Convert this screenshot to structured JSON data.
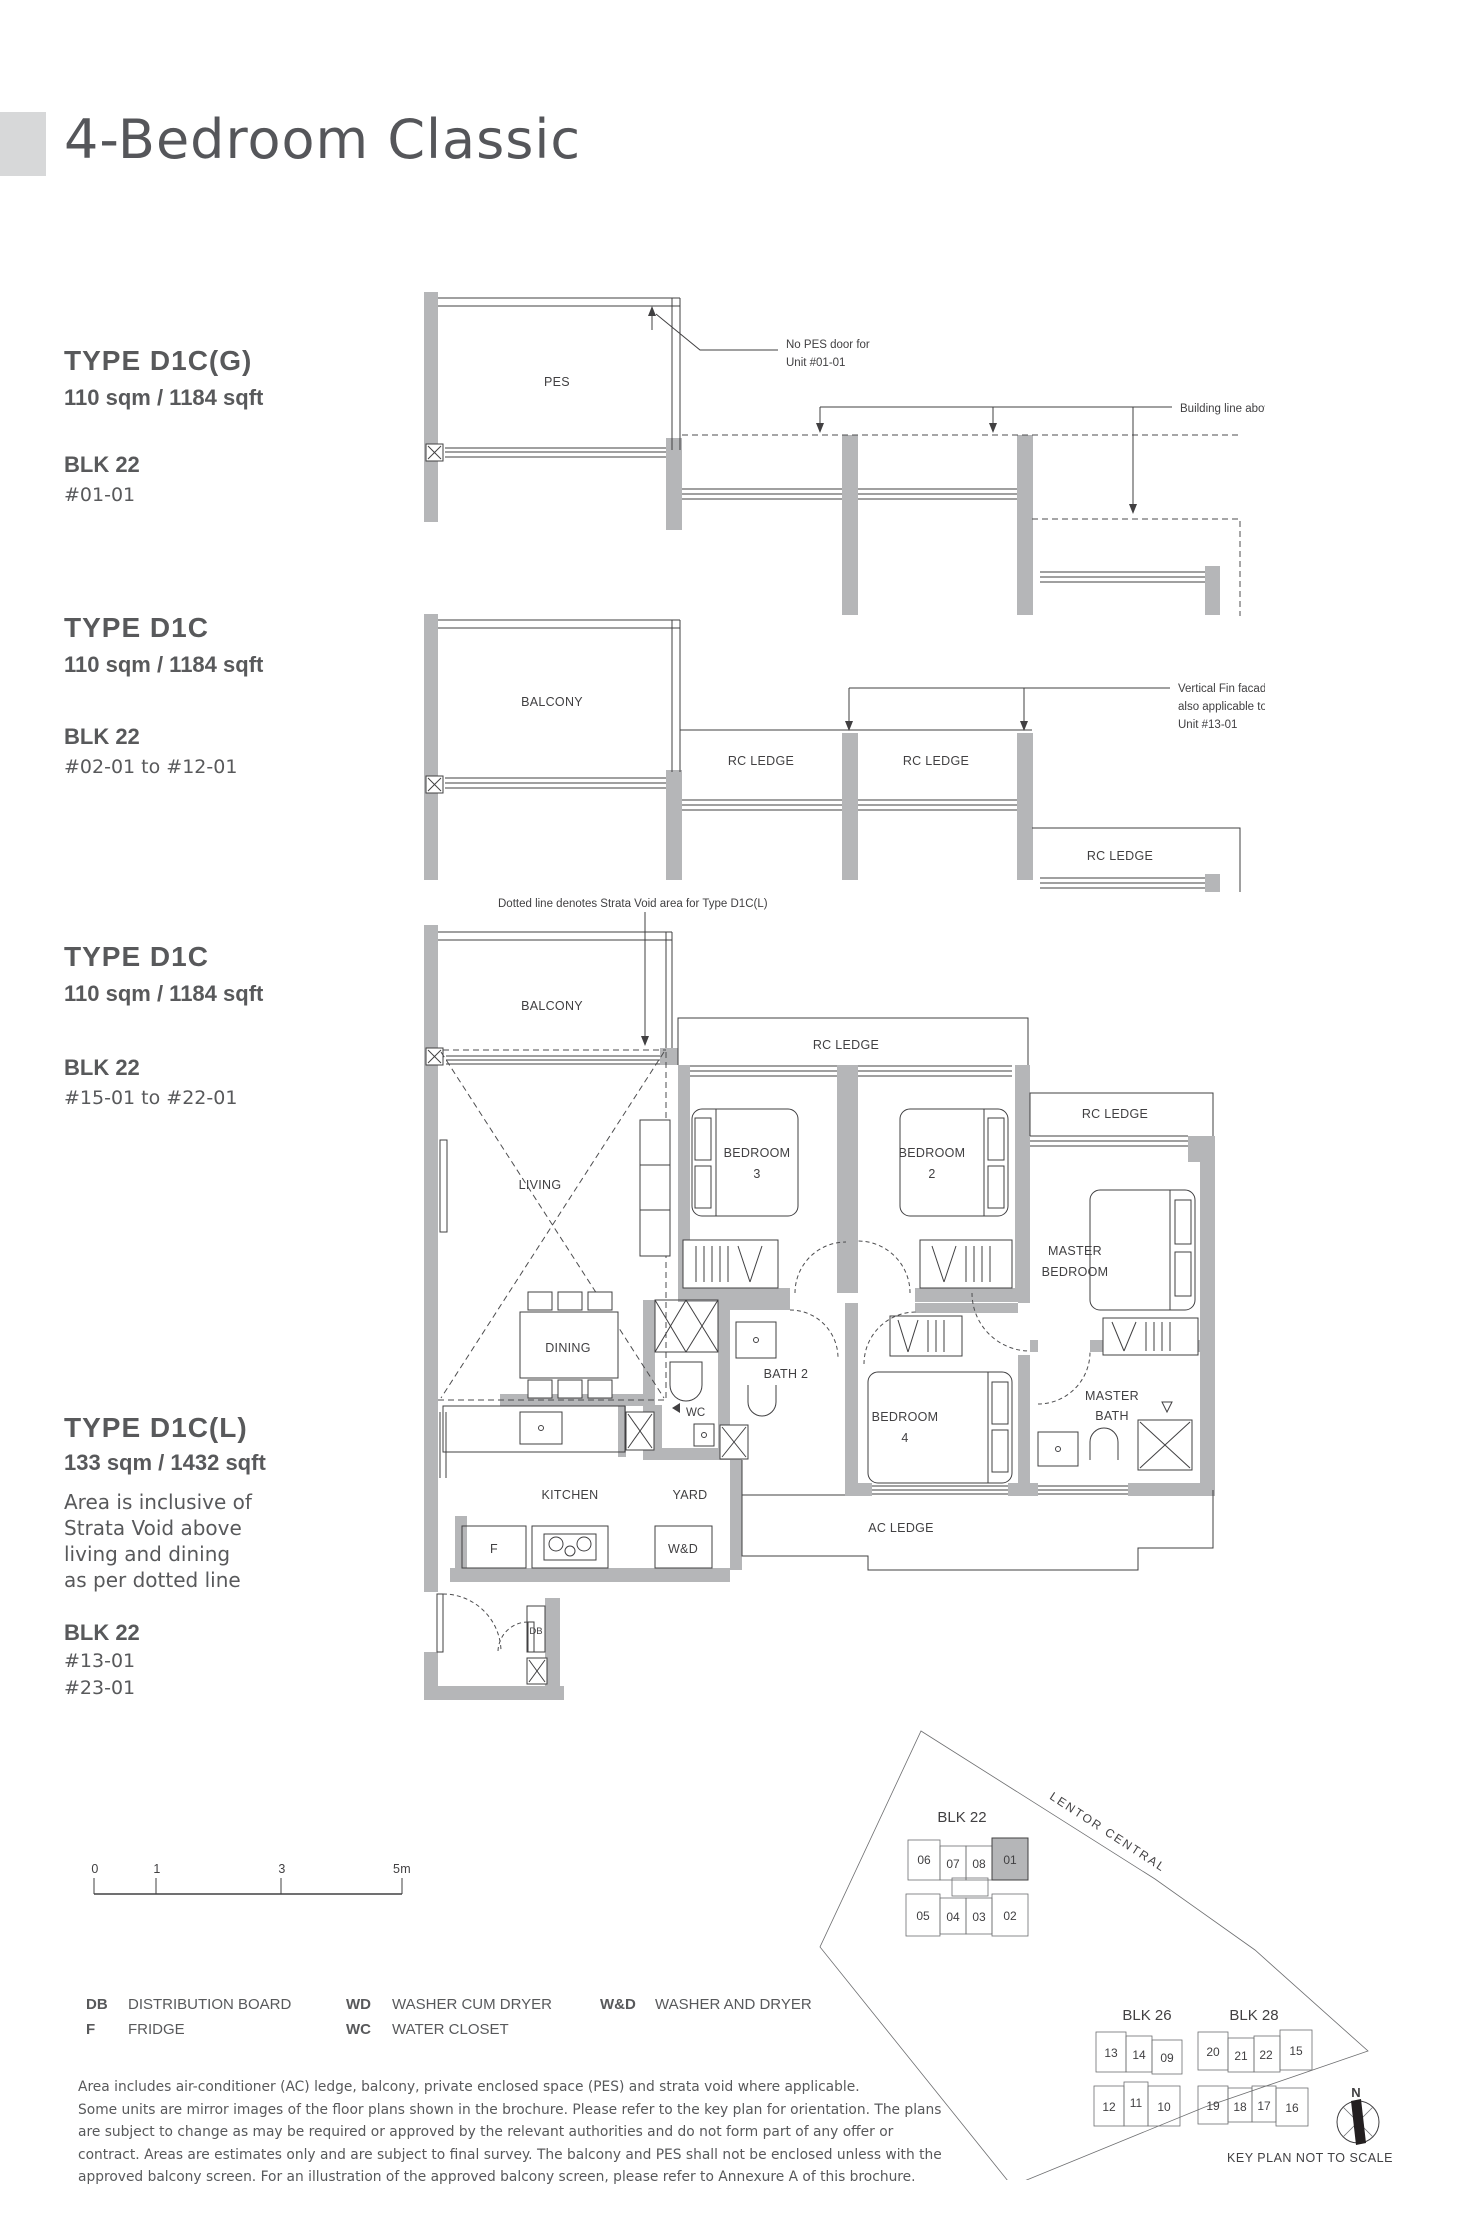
{
  "page": {
    "title": "4-Bedroom Classic"
  },
  "colors": {
    "text": "#58595b",
    "line": "#414042",
    "wall": "#b5b6b8",
    "highlight": "#b5b6b8"
  },
  "sections": {
    "s1": {
      "type_label": "TYPE D1C(G)",
      "area": "110 sqm / 1184 sqft",
      "blk": "BLK 22",
      "units": "#01-01"
    },
    "s2": {
      "type_label": "TYPE D1C",
      "area": "110 sqm / 1184 sqft",
      "blk": "BLK 22",
      "units": "#02-01 to #12-01"
    },
    "s3": {
      "type_label": "TYPE D1C",
      "area": "110 sqm / 1184 sqft",
      "blk": "BLK 22",
      "units": "#15-01 to #22-01"
    },
    "s4": {
      "type_label": "TYPE D1C(L)",
      "area": "133 sqm / 1432 sqft",
      "note1": "Area is inclusive of",
      "note2": "Strata Void above",
      "note3": "living and dining",
      "note4": "as per dotted line",
      "blk": "BLK 22",
      "units1": "#13-01",
      "units2": "#23-01"
    }
  },
  "plan1": {
    "pes": "PES",
    "note_pes1": "No PES door for",
    "note_pes2": "Unit #01-01",
    "note_building": "Building line above"
  },
  "plan2": {
    "balcony": "BALCONY",
    "rc_ledge1": "RC LEDGE",
    "rc_ledge2": "RC LEDGE",
    "rc_ledge3": "RC LEDGE",
    "fin1": "Vertical Fin facade",
    "fin2": "also applicable to",
    "fin3": "Unit #13-01"
  },
  "plan3": {
    "strata_note": "Dotted line denotes Strata Void area for Type D1C(L)",
    "balcony": "BALCONY",
    "living": "LIVING",
    "dining": "DINING",
    "kitchen": "KITCHEN",
    "yard": "YARD",
    "wc": "WC",
    "bath2": "BATH 2",
    "db": "DB",
    "f": "F",
    "wd": "W&D",
    "rc_ledge_top": "RC LEDGE",
    "rc_ledge_right": "RC LEDGE",
    "ac_ledge": "AC LEDGE",
    "bedroom3a": "BEDROOM",
    "bedroom3b": "3",
    "bedroom2a": "BEDROOM",
    "bedroom2b": "2",
    "bedroom4a": "BEDROOM",
    "bedroom4b": "4",
    "master1": "MASTER",
    "master2": "BEDROOM",
    "mbath1": "MASTER",
    "mbath2": "BATH"
  },
  "scalebar": {
    "t0": "0",
    "t1": "1",
    "t3": "3",
    "t5": "5m"
  },
  "legend": {
    "db_abbr": "DB",
    "db": "DISTRIBUTION BOARD",
    "f_abbr": "F",
    "f": "FRIDGE",
    "wd_abbr": "WD",
    "wd": "WASHER CUM DRYER",
    "wc_abbr": "WC",
    "wc": "WATER CLOSET",
    "wnd_abbr": "W&D",
    "wnd": "WASHER AND DRYER"
  },
  "disclaimer": {
    "l1": "Area includes air-conditioner (AC) ledge, balcony, private enclosed space (PES) and strata void where applicable.",
    "l2": "Some units are mirror images of the floor plans shown in the brochure. Please refer to the key plan for orientation. The plans",
    "l3": "are subject to change as may be required or approved by the relevant authorities and do not form part of any offer or",
    "l4": "contract. Areas are estimates only and are subject to final survey. The balcony and PES shall not be enclosed unless with the",
    "l5": "approved balcony screen. For an illustration of the approved balcony screen, please refer to Annexure A of this brochure."
  },
  "keyplan": {
    "road": "LENTOR CENTRAL",
    "blk22": "BLK 22",
    "blk26": "BLK 26",
    "blk28": "BLK 28",
    "caption": "KEY PLAN NOT TO SCALE",
    "north": "N",
    "blk22_top": [
      "06",
      "07",
      "08",
      "01"
    ],
    "blk22_bottom": [
      "05",
      "04",
      "03",
      "02"
    ],
    "blk26_top": [
      "13",
      "14",
      "09"
    ],
    "blk26_bottom": [
      "12",
      "11",
      "10"
    ],
    "blk28_top": [
      "20",
      "21",
      "22",
      "15"
    ],
    "blk28_bottom": [
      "19",
      "18",
      "17",
      "16"
    ]
  }
}
